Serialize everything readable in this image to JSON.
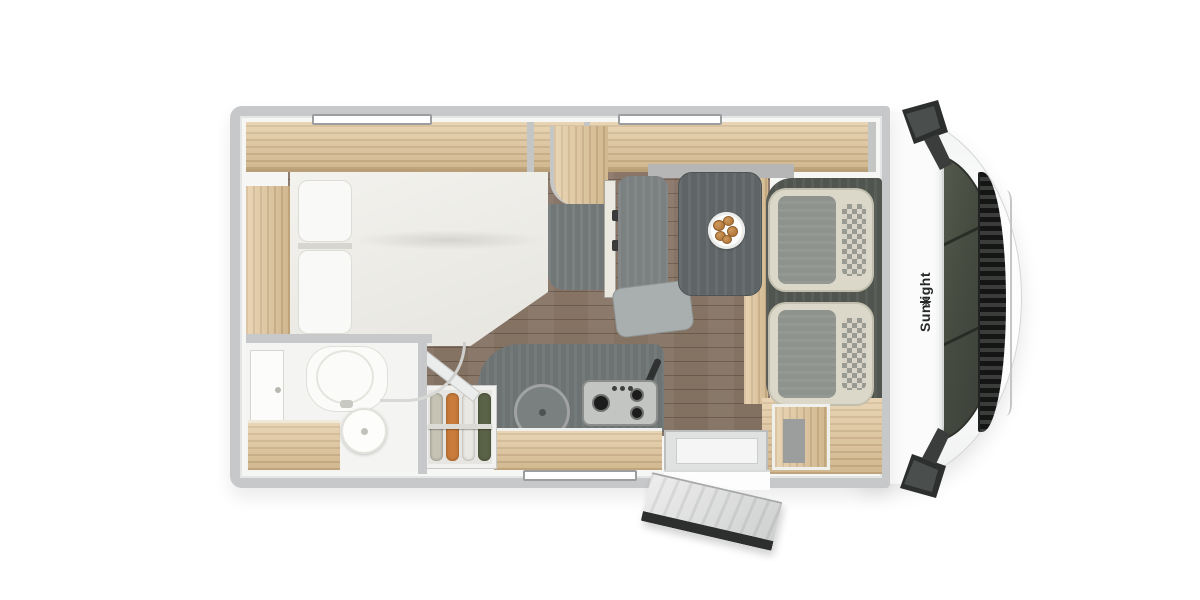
{
  "page": {
    "description": "Top-down 3D rendering of a Sunlight semi-integrated motorhome floor plan, front cab on the right, entry door open at the bottom"
  },
  "brand": {
    "wordmark": "Sunlight",
    "logo_glyph": "✳"
  },
  "colors": {
    "wall": "#c7c8c9",
    "wood": "#e2c79c",
    "wood_deep": "#cfae80",
    "floor": "#8a7669",
    "cab_floor": "#50554f",
    "table": "#5f6566",
    "unit_grey": "#717677",
    "bench": "#7b8081",
    "seat_beige": "#dcd8c9",
    "seat_grey": "#8e938d",
    "bath": "#f4f4f3",
    "counter": "#6d7273",
    "hob": "#c2c5c2",
    "plate": "#ffffff",
    "pastry": "#b57a3e",
    "clothes1": "#c6c3b5",
    "clothes2": "#c97b3a",
    "clothes3": "#eae8e2",
    "clothes4": "#5a6347"
  },
  "inventory": {
    "rooms": [
      "rear-bedroom",
      "bathroom",
      "kitchen",
      "dinette",
      "driver-cab"
    ],
    "windows": 3,
    "cab_seats": 2,
    "hob_burners": 3,
    "wardrobe_garments": 4,
    "plate_pastries": 5,
    "entry_door_state": "open",
    "furniture": [
      "french-bed",
      "rear-wardrobe",
      "overhead-lockers",
      "tv",
      "fridge-tall-unit",
      "dinette-table",
      "dinette-bench",
      "kitchen-sink",
      "gas-hob",
      "clothes-wardrobe",
      "toilet",
      "washbasin",
      "vanity",
      "shower",
      "entry-step",
      "swivel-cab-seats"
    ]
  }
}
